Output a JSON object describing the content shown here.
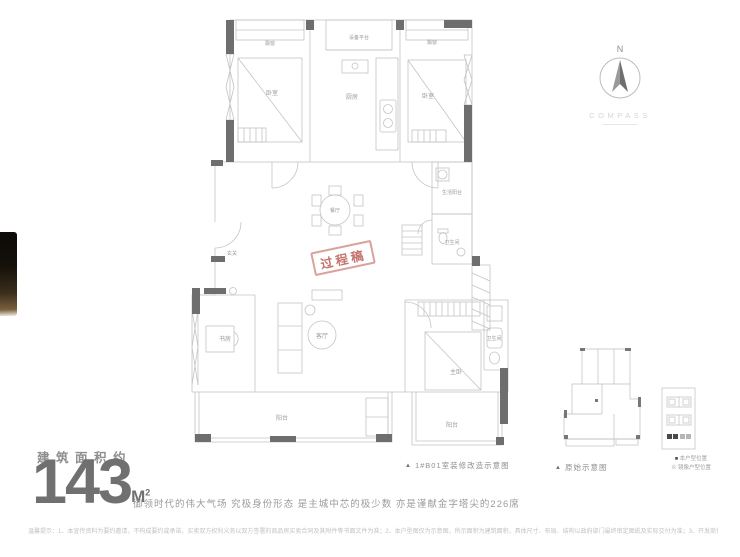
{
  "compass": {
    "north_label": "N",
    "caption": "COMPASS"
  },
  "floor_plan": {
    "caption_marker": "▲",
    "caption": "1#B01室装修改造示意图",
    "stamp": "过程稿",
    "stamp_color": "#c06e66",
    "rooms": {
      "bay_window_left": "飘窗",
      "equipment_platform": "设备平台",
      "bay_window_right": "飘窗",
      "bedroom_left": "卧室",
      "kitchen": "厨房",
      "bedroom_right": "卧室",
      "dining": "餐厅",
      "foyer": "玄关",
      "service_balcony": "生活阳台",
      "bathroom": "卫生间",
      "study": "书房",
      "living": "客厅",
      "master_bedroom": "主卧",
      "master_bathroom": "卫生间",
      "balcony": "阳台",
      "side_balcony": "阳台"
    }
  },
  "mini_plan": {
    "caption_marker": "▲",
    "caption": "原始示意图"
  },
  "stack_diagram": {
    "legend": {
      "current_marker": "■",
      "current_label": "本户型位置",
      "mirror_marker": "※",
      "mirror_label": "镜像户型位置"
    }
  },
  "area": {
    "label": "建筑面积约",
    "value": "143",
    "unit": "M",
    "unit_exponent": "2",
    "tagline": "御领时代的伟大气场 究极身份形态 是主城中芯的极少数 亦是谨献金字塔尖的226席"
  },
  "disclaimer": "温馨提示：1、本宣传资料为要约邀请，不构成要约或承诺，买卖双方权利义务以双方签署的商品房买卖合同及其附件等书面文件为准；2、本户型图仅为示意图，所示面积为建筑面积，具体尺寸、布局、结构以政府部门最终审定图纸及实际交付为准；3、开发商保留对宣传资料修改的权利，敬请留意最新资料。"
}
